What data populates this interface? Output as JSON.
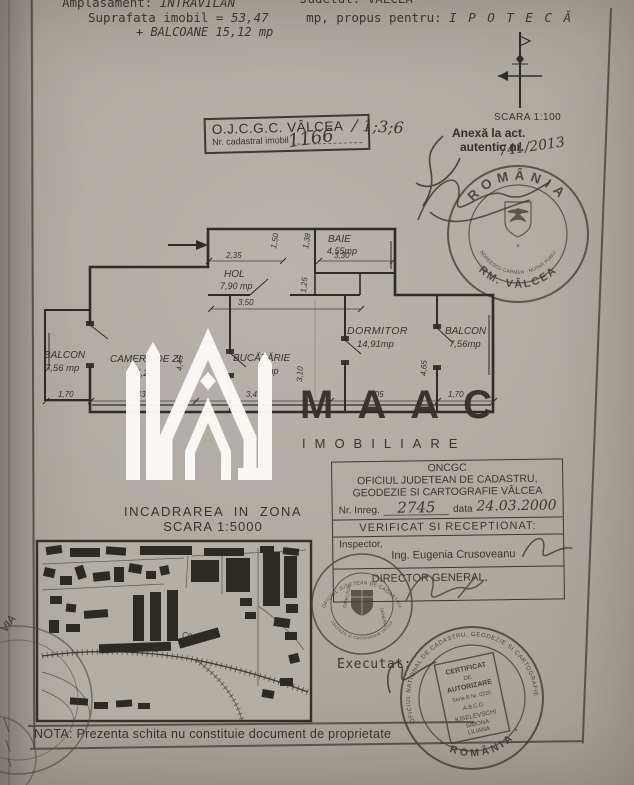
{
  "colors": {
    "paper": "#aca69e",
    "ink": "#36322b",
    "watermark": "#fbfaf7"
  },
  "header": {
    "amplasament_label": "Amplasament:",
    "amplasament_value": "INTRAVILAN",
    "judet": "Judetul: VÂLCEA",
    "suprafata_label": "Suprafata imobil =",
    "suprafata_value": "53,47",
    "propus_label": "mp, propus pentru:",
    "propus_value": "I P O T E C Ă",
    "balcoane": "+ BALCOANE 15,12 mp"
  },
  "cadastral_box": {
    "title": "O.J.C.G.C. VÂLCEA",
    "nr_label": "Nr. cadastral imobil",
    "nr_value": "1166",
    "nr_suffix": "/ 1;3;6"
  },
  "scara": "SCARA 1:100",
  "anexa": {
    "line1": "Anexă la act.",
    "line2": "autentic nr.",
    "value": "741/2013"
  },
  "notary_stamp": {
    "country": "ROMÂNIA",
    "ring": "ANDREESCU CARMEN · NOTAR PUBLIC",
    "city": "RM. VÂLCEA",
    "star": "*"
  },
  "plan": {
    "rooms": {
      "baie": {
        "name": "BAIE",
        "area": "4,55mp"
      },
      "hol": {
        "name": "HOL",
        "area": "7,90 mp"
      },
      "dormitor": {
        "name": "DORMITOR",
        "area": "14,91mp"
      },
      "balcon_left": {
        "name": "BALCON",
        "area": "7,56 mp"
      },
      "balcon_right": {
        "name": "BALCON",
        "area": "7,56mp"
      },
      "camera": {
        "name": "CAMERĂ DE ZI",
        "area": "15,26"
      },
      "bucatarie": {
        "name": "BUCĂTĂRIE",
        "area": "mp"
      }
    },
    "dims": {
      "w235": "2,35",
      "w150": "1,50",
      "w138": "1,38",
      "w330": "3,30",
      "w350": "3,50",
      "w125": "1,25",
      "b170a": "1,70",
      "b343": "3,43",
      "b347": "3,47",
      "b405": "4,05",
      "b170b": "1,70",
      "v445": "4,45",
      "v310": "3,10",
      "v465": "4,65"
    }
  },
  "watermark": {
    "brand": "MAAC",
    "sub": "IMOBILIARE"
  },
  "oncgc": {
    "org": "ONCGC",
    "office1": "OFICIUL JUDETEAN DE CADASTRU,",
    "office2": "GEODEZIE SI CARTOGRAFIE VÂLCEA",
    "nr_label": "Nr. Inreg.",
    "nr_value": "2745",
    "data_label": "data",
    "data_value": "24.03.2000",
    "verificat": "VERIFICAT SI RECEPTIONAT:",
    "inspector_label": "Inspector,",
    "inspector_name": "Ing. Eugenia Crusoveanu",
    "director": "DIRECTOR GENERAL,"
  },
  "incadrare": {
    "title": "INCADRAREA  IN  ZONA",
    "scale": "SCARA 1:5000"
  },
  "map_labels": {
    "cp": "Cp",
    "five": "5",
    "plus": "+1,1"
  },
  "judet_stamp": {
    "ring_top": "OFICIUL JUDETEAN DE CADASTRU",
    "ring_bottom": "GEODEZIE SI CARTOGRAFIE VALCEA",
    "left": "DIRECTOR",
    "right": "GENERAL"
  },
  "executat_label": "Executat:",
  "cert_stamp": {
    "ring_top": "OFICIUL NATIONAL DE CADASTRU, GEODEZIE SI CARTOGRAFIE",
    "ring_bottom": "· ROMÂNIA ·",
    "lines": [
      "CERTIFICAT",
      "DE",
      "AUTORIZARE",
      "Seria B Nr. 0220",
      "A.B.C.D.",
      "KISELEVSCHI",
      "SIMONA",
      "LILIANA"
    ]
  },
  "margin_note": "VIA",
  "nota": "NOTA: Prezenta schita nu constituie document de proprietate"
}
